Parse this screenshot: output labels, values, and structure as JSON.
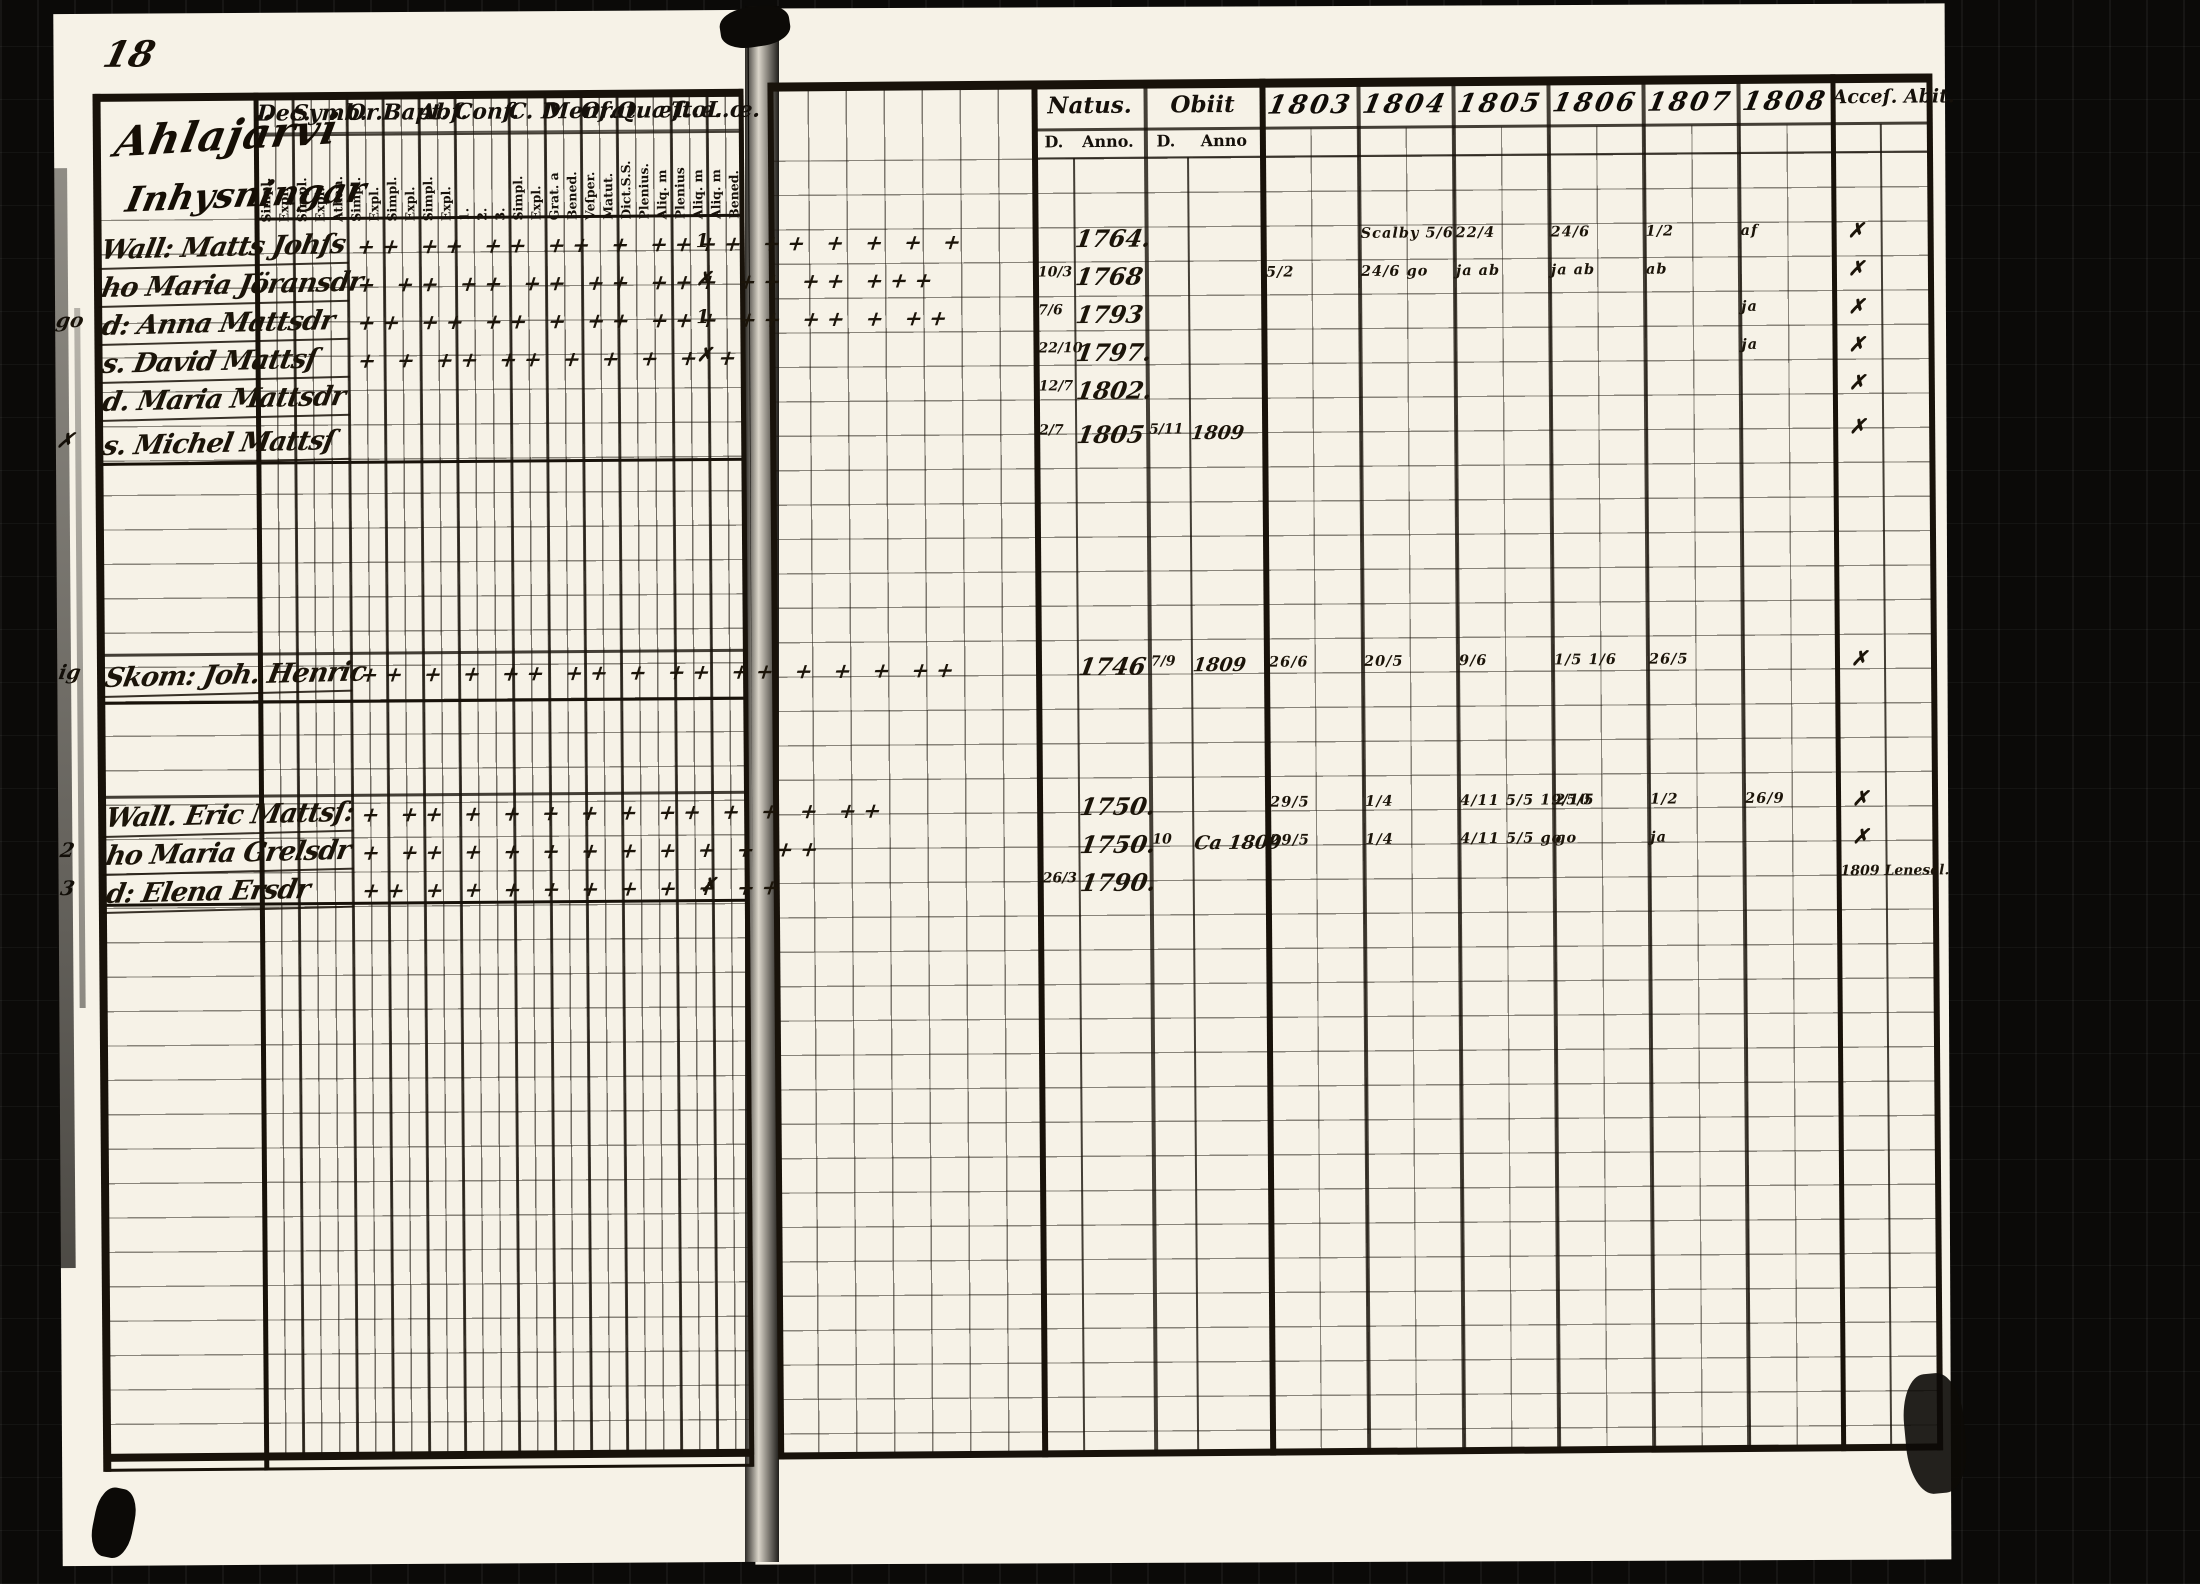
{
  "colors": {
    "paper": "#f6f2e7",
    "ink": "#1b1409",
    "frame": "#0b0a08"
  },
  "page": {
    "number": "18",
    "title_line1": "Ahlajärvi",
    "title_line2": "Inhysningar"
  },
  "left_headers": [
    {
      "label": "Dec.",
      "subs": [
        "Simpl.",
        "Expl."
      ]
    },
    {
      "label": "Symb.",
      "subs": [
        "Simpl.",
        "Expl.",
        "Athan."
      ]
    },
    {
      "label": "Or.L",
      "subs": [
        "Simpl.",
        "Expl."
      ]
    },
    {
      "label": "Bapt.",
      "subs": [
        "Simpl.",
        "Expl."
      ]
    },
    {
      "label": "Abſ.",
      "subs": [
        "Simpl.",
        "Expl."
      ]
    },
    {
      "label": "Conf.",
      "subs": [
        "1.",
        "2.",
        "3."
      ]
    },
    {
      "label": "C. D",
      "subs": [
        "Simpl.",
        "Expl."
      ]
    },
    {
      "label": "Menſ.",
      "subs": [
        "Grat. a",
        "Bened."
      ]
    },
    {
      "label": "Orat.",
      "subs": [
        "Veſper.",
        "Matut."
      ]
    },
    {
      "label": "Quæſt.",
      "subs": [
        "Dict.S.S.",
        "Plenius.",
        "Aliq. m"
      ]
    },
    {
      "label": "T.œ.",
      "subs": [
        "Plenius",
        "Aliq. m"
      ]
    },
    {
      "label": "L.œ.",
      "subs": [
        "Aliq. m",
        "Bened."
      ]
    }
  ],
  "right_headers": {
    "natus_label": "Natus.",
    "natus_d": "D.",
    "natus_anno": "Anno.",
    "obiit_label": "Obiit",
    "obiit_d": "D.",
    "obiit_anno": "Anno",
    "years": [
      "1803",
      "1804",
      "1805",
      "1806",
      "1807",
      "1808"
    ],
    "acces_abit": "Acceſ. Abit."
  },
  "rows": [
    {
      "margin": "",
      "name": "Wall: Matts Johſs",
      "marks": "++ ++ ++ ++ + ++++ ++ + + + +",
      "lm": "1",
      "natus_d": "",
      "natus_anno": "1764.",
      "obiit_d": "",
      "obiit_anno": "",
      "y1803": "",
      "y1804": "Scalby 5/6",
      "y1805": "22/4",
      "y1806": "24/6",
      "y1807": "1/2",
      "y1808": "af",
      "abit": "✗",
      "note": ""
    },
    {
      "margin": "",
      "name": "ho Maria Jöransdr",
      "marks": "+ ++ ++ ++ ++ +++ ++ ++ +++",
      "lm": "✗",
      "natus_d": "10/3",
      "natus_anno": "1768",
      "obiit_d": "",
      "obiit_anno": "",
      "y1803": "5/2",
      "y1804": "24/6 go",
      "y1805": "ja ab",
      "y1806": "ja ab",
      "y1807": "ab",
      "y1808": "",
      "abit": "✗",
      "note": ""
    },
    {
      "margin": "go",
      "name": "d: Anna Mattsdr",
      "marks": "++ ++ ++ + ++ +++ ++ ++ + ++",
      "lm": "1",
      "natus_d": "7/6",
      "natus_anno": "1793",
      "obiit_d": "",
      "obiit_anno": "",
      "y1803": "",
      "y1804": "",
      "y1805": "",
      "y1806": "",
      "y1807": "",
      "y1808": "ja",
      "abit": "✗",
      "note": ""
    },
    {
      "margin": "",
      "name": "s. David Mattsſ",
      "marks": "+ + ++ ++  +  +  +  + +",
      "lm": "✗",
      "natus_d": "22/10",
      "natus_anno": "1797.",
      "obiit_d": "",
      "obiit_anno": "",
      "y1803": "",
      "y1804": "",
      "y1805": "",
      "y1806": "",
      "y1807": "",
      "y1808": "ja",
      "abit": "✗",
      "note": ""
    },
    {
      "margin": "",
      "name": "d. Maria Mattsdr",
      "marks": "",
      "lm": "",
      "natus_d": "12/7",
      "natus_anno": "1802.",
      "obiit_d": "",
      "obiit_anno": "",
      "y1803": "",
      "y1804": "",
      "y1805": "",
      "y1806": "",
      "y1807": "",
      "y1808": "",
      "abit": "✗",
      "note": ""
    },
    {
      "margin": "✗",
      "name": "s. Michel Mattsſ",
      "marks": "",
      "lm": "",
      "natus_d": "2/7",
      "natus_anno": "1805",
      "obiit_d": "5/11",
      "obiit_anno": "1809",
      "y1803": "",
      "y1804": "",
      "y1805": "",
      "y1806": "",
      "y1807": "",
      "y1808": "",
      "abit": "✗",
      "note": ""
    },
    {
      "margin": "ig",
      "name": "Skom: Joh. Henric",
      "marks": "++ + + ++ ++  + ++ ++ + + + ++",
      "lm": "",
      "natus_d": "",
      "natus_anno": "1746",
      "obiit_d": "7/9",
      "obiit_anno": "1809",
      "y1803": "26/6",
      "y1804": "20/5",
      "y1805": "9/6",
      "y1806": "1/5 1/6",
      "y1807": "26/5",
      "y1808": "",
      "abit": "✗",
      "note": ""
    },
    {
      "margin": "",
      "name": "Wall. Eric Mattsſ:",
      "marks": "+ ++ + + + +  + ++ + + + ++",
      "lm": "",
      "natus_d": "",
      "natus_anno": "1750.",
      "obiit_d": "",
      "obiit_anno": "",
      "y1803": "29/5",
      "y1804": "1/4",
      "y1805": "4/11 5/5 19/10",
      "y1806": "25/5",
      "y1807": "1/2",
      "y1808": "26/9",
      "abit": "✗",
      "note": ""
    },
    {
      "margin": "2",
      "name": "ho Maria Grelsdr",
      "marks": "+ ++ + + + +  + + + + ++",
      "lm": "",
      "natus_d": "",
      "natus_anno": "1750.",
      "obiit_d": "10",
      "obiit_anno": "Ca 1809",
      "y1803": "29/5",
      "y1804": "1/4",
      "y1805": "4/11 5/5 go",
      "y1806": "go",
      "y1807": "ja",
      "y1808": "",
      "abit": "✗",
      "note": ""
    },
    {
      "margin": "3",
      "name": "d: Elena Ersdr",
      "marks": "++ + + + + + +  + + ++",
      "lm": "✗",
      "natus_d": "26/3",
      "natus_anno": "1790.",
      "obiit_d": "",
      "obiit_anno": "",
      "y1803": "",
      "y1804": "",
      "y1805": "",
      "y1806": "",
      "y1807": "",
      "y1808": "",
      "abit": "",
      "note": "1809 Lenesel."
    }
  ]
}
